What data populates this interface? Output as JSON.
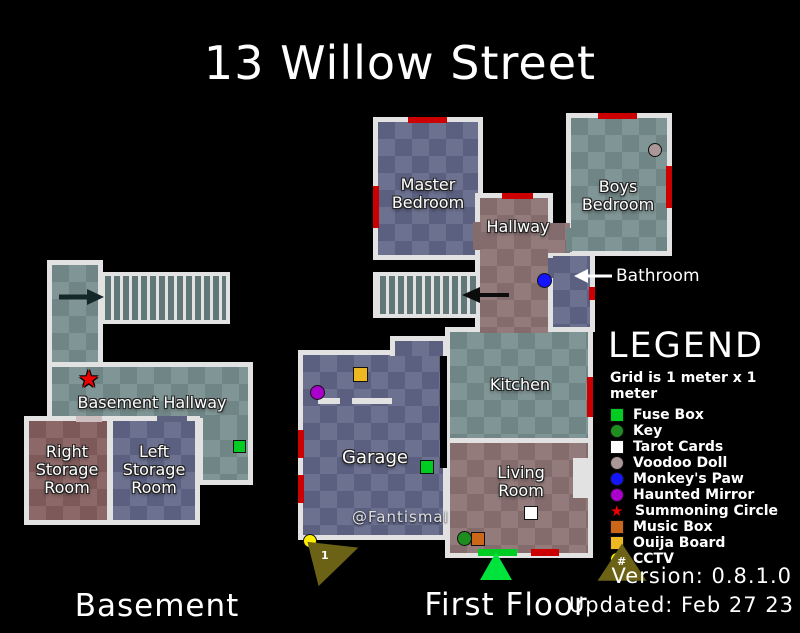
{
  "title": "13 Willow Street",
  "credit": "@Fantismal",
  "version_line": "Version: 0.8.1.0",
  "updated_line": "Updated: Feb 27 23",
  "floors": {
    "basement": {
      "label": "Basement",
      "rooms": {
        "hallway": "Basement Hallway",
        "right_storage": "Right Storage Room",
        "left_storage": "Left Storage Room"
      }
    },
    "first": {
      "label": "First Floor",
      "rooms": {
        "master_bedroom": "Master Bedroom",
        "boys_bedroom": "Boys Bedroom",
        "hallway": "Hallway",
        "bathroom": "Bathroom",
        "kitchen": "Kitchen",
        "living_room": "Living Room",
        "garage": "Garage"
      }
    }
  },
  "legend": {
    "title": "LEGEND",
    "grid_note": "Grid is 1 meter x 1 meter",
    "items": [
      {
        "label": "Fuse Box",
        "icon": "green-square",
        "color": "#00cc22"
      },
      {
        "label": "Key",
        "icon": "green-circle",
        "color": "#1e8c1e"
      },
      {
        "label": "Tarot Cards",
        "icon": "white-square",
        "color": "#ffffff"
      },
      {
        "label": "Voodoo Doll",
        "icon": "gray-circle",
        "color": "#ab9797"
      },
      {
        "label": "Monkey's Paw",
        "icon": "blue-circle",
        "color": "#1414ff"
      },
      {
        "label": "Haunted Mirror",
        "icon": "purple-circle",
        "color": "#aa00cc"
      },
      {
        "label": "Summoning Circle",
        "icon": "red-star",
        "color": "#ee0000",
        "symbol": "★"
      },
      {
        "label": "Music Box",
        "icon": "orange-square",
        "color": "#cc6618"
      },
      {
        "label": "Ouija Board",
        "icon": "gold-square",
        "color": "#eeb822"
      },
      {
        "label": "CCTV",
        "icon": "yellow-circle",
        "color": "#ffee00"
      }
    ]
  },
  "markers": {
    "camera_garage_label": "1",
    "camera_legend_symbol": "#"
  },
  "map_colors": {
    "door_red": "#cc0000",
    "door_green": "#00cc22",
    "entry_marker": "#00e23c",
    "cctv_cone": "#6b6216"
  }
}
